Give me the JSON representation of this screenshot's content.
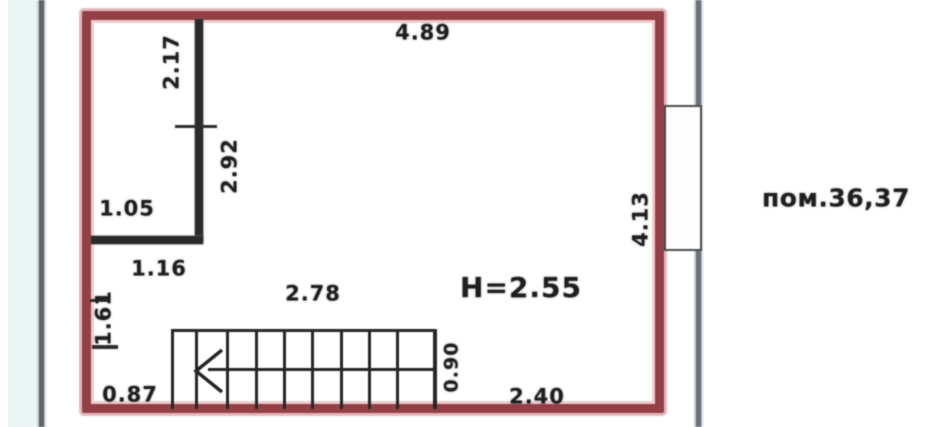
{
  "plan": {
    "title": "apartment-floor-plan-fragment",
    "room_label": "пом.36,37",
    "ceiling_height": "H=2.55",
    "dimensions": {
      "top_width": "4.89",
      "closet_height": "2.17",
      "partition_lower": "2.92",
      "closet_width": "1.05",
      "below_closet": "1.16",
      "left_lower": "1.61",
      "bottom_left": "0.87",
      "stair_length": "2.78",
      "stair_width": "0.90",
      "bottom_right": "2.40",
      "right_wall": "4.13"
    },
    "colors": {
      "wall_red": "#943f46",
      "wall_red_halo": "#e3b9bc",
      "partition_black": "#2b2b2b",
      "section_line_gray": "#5d656b",
      "azure_tint": "#e9f5f3",
      "text": "#1f1f1f"
    }
  }
}
